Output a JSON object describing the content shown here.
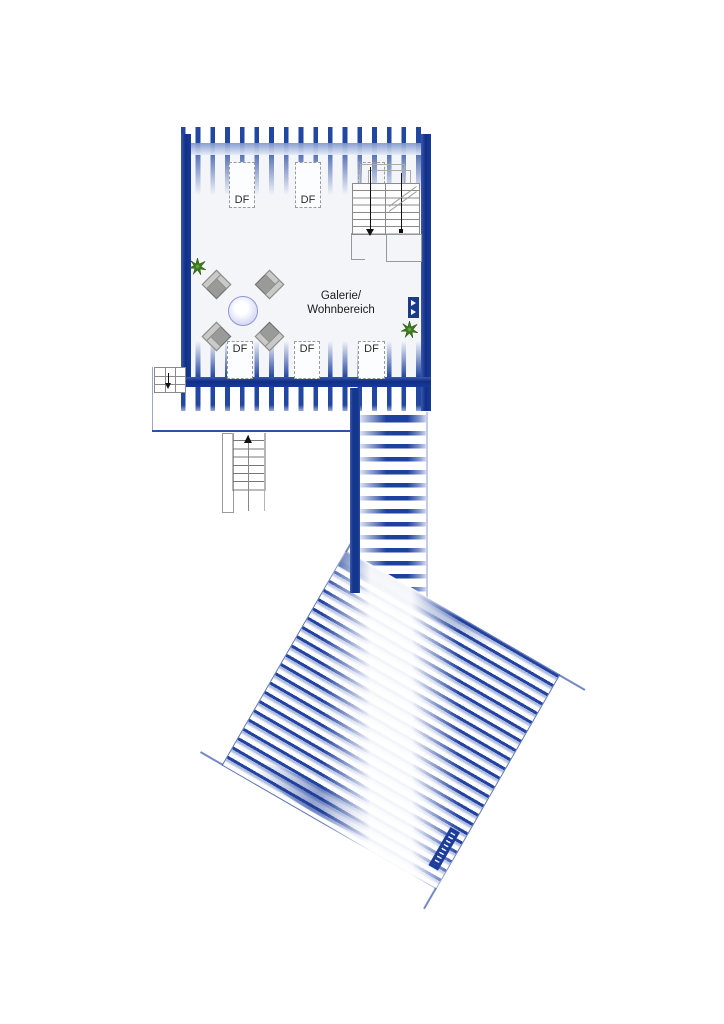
{
  "plan": {
    "type": "floor-plan",
    "room": {
      "label_line1": "Galerie/",
      "label_line2": "Wohnbereich"
    },
    "roof_windows": [
      {
        "label": "DF",
        "position": "top-left"
      },
      {
        "label": "DF",
        "position": "top-middle"
      },
      {
        "label": "DF",
        "position": "top-at-stairs"
      },
      {
        "label": "DF",
        "position": "bottom-left"
      },
      {
        "label": "DF",
        "position": "bottom-middle"
      },
      {
        "label": "DF",
        "position": "bottom-right"
      }
    ],
    "stairs": {
      "upper_flights": 2,
      "direction_markers": [
        "down-arrow",
        "start-dot"
      ],
      "lower_exit_marker": "up-arrow",
      "mini_stair_marker": "down-arrow"
    },
    "furniture": {
      "table": "round-table",
      "chairs": 4,
      "plants": 2
    },
    "watermark": {
      "text": ""
    },
    "colors": {
      "wall_blue": "#163a99",
      "stripe_blue": "#2247a2",
      "stripe_light": "#a9b7e0",
      "floor": "#f3f5f9",
      "chair_gray": "#9a9a98",
      "table_fill": "#d7daf4",
      "plant_green": "#3c7a1d",
      "line_gray": "#8a8a8a"
    }
  }
}
